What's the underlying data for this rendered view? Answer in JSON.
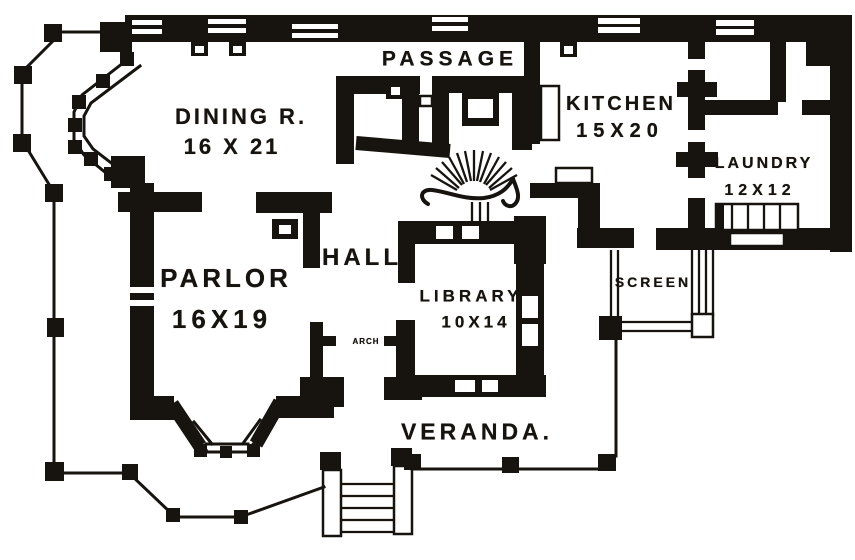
{
  "colors": {
    "ink": "#17130e",
    "paper": "#ffffff"
  },
  "rooms": {
    "passage": {
      "label": "PASSAGE"
    },
    "dining": {
      "label": "DINING R.",
      "dims": "16 X 21"
    },
    "kitchen": {
      "label": "KITCHEN",
      "dims": "15X20"
    },
    "laundry": {
      "label": "LAUNDRY",
      "dims": "12X12"
    },
    "parlor": {
      "label": "PARLOR",
      "dims": "16X19"
    },
    "hall": {
      "label": "HALL"
    },
    "library": {
      "label": "LIBRARY",
      "dims": "10X14"
    },
    "arch": {
      "label": "ARCH"
    },
    "screen": {
      "label": "SCREEN"
    },
    "veranda": {
      "label": "VERANDA."
    }
  }
}
